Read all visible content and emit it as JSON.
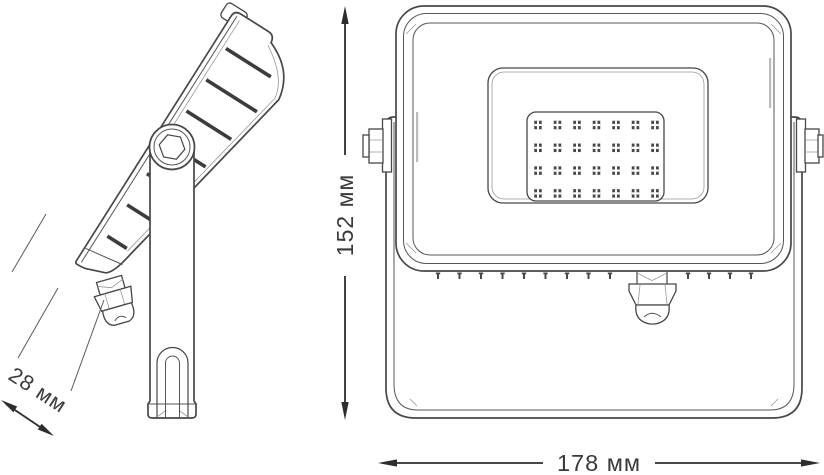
{
  "drawing": {
    "dimension_labels": {
      "depth": "28 мм",
      "height": "152 мм",
      "width": "178 мм"
    },
    "side_view": {
      "fins_count": 7
    },
    "front_view": {
      "led_grid": {
        "columns": 7,
        "rows": 4
      },
      "vent_ticks": {
        "left_count": 9,
        "right_count": 4
      }
    },
    "colors": {
      "background": "#ffffff",
      "line": "#474747",
      "line_light": "#999999",
      "fin": "#3c3c3c",
      "led": "#474747",
      "dimension_line": "#2d2d2d",
      "text": "#3a3a3a"
    }
  }
}
